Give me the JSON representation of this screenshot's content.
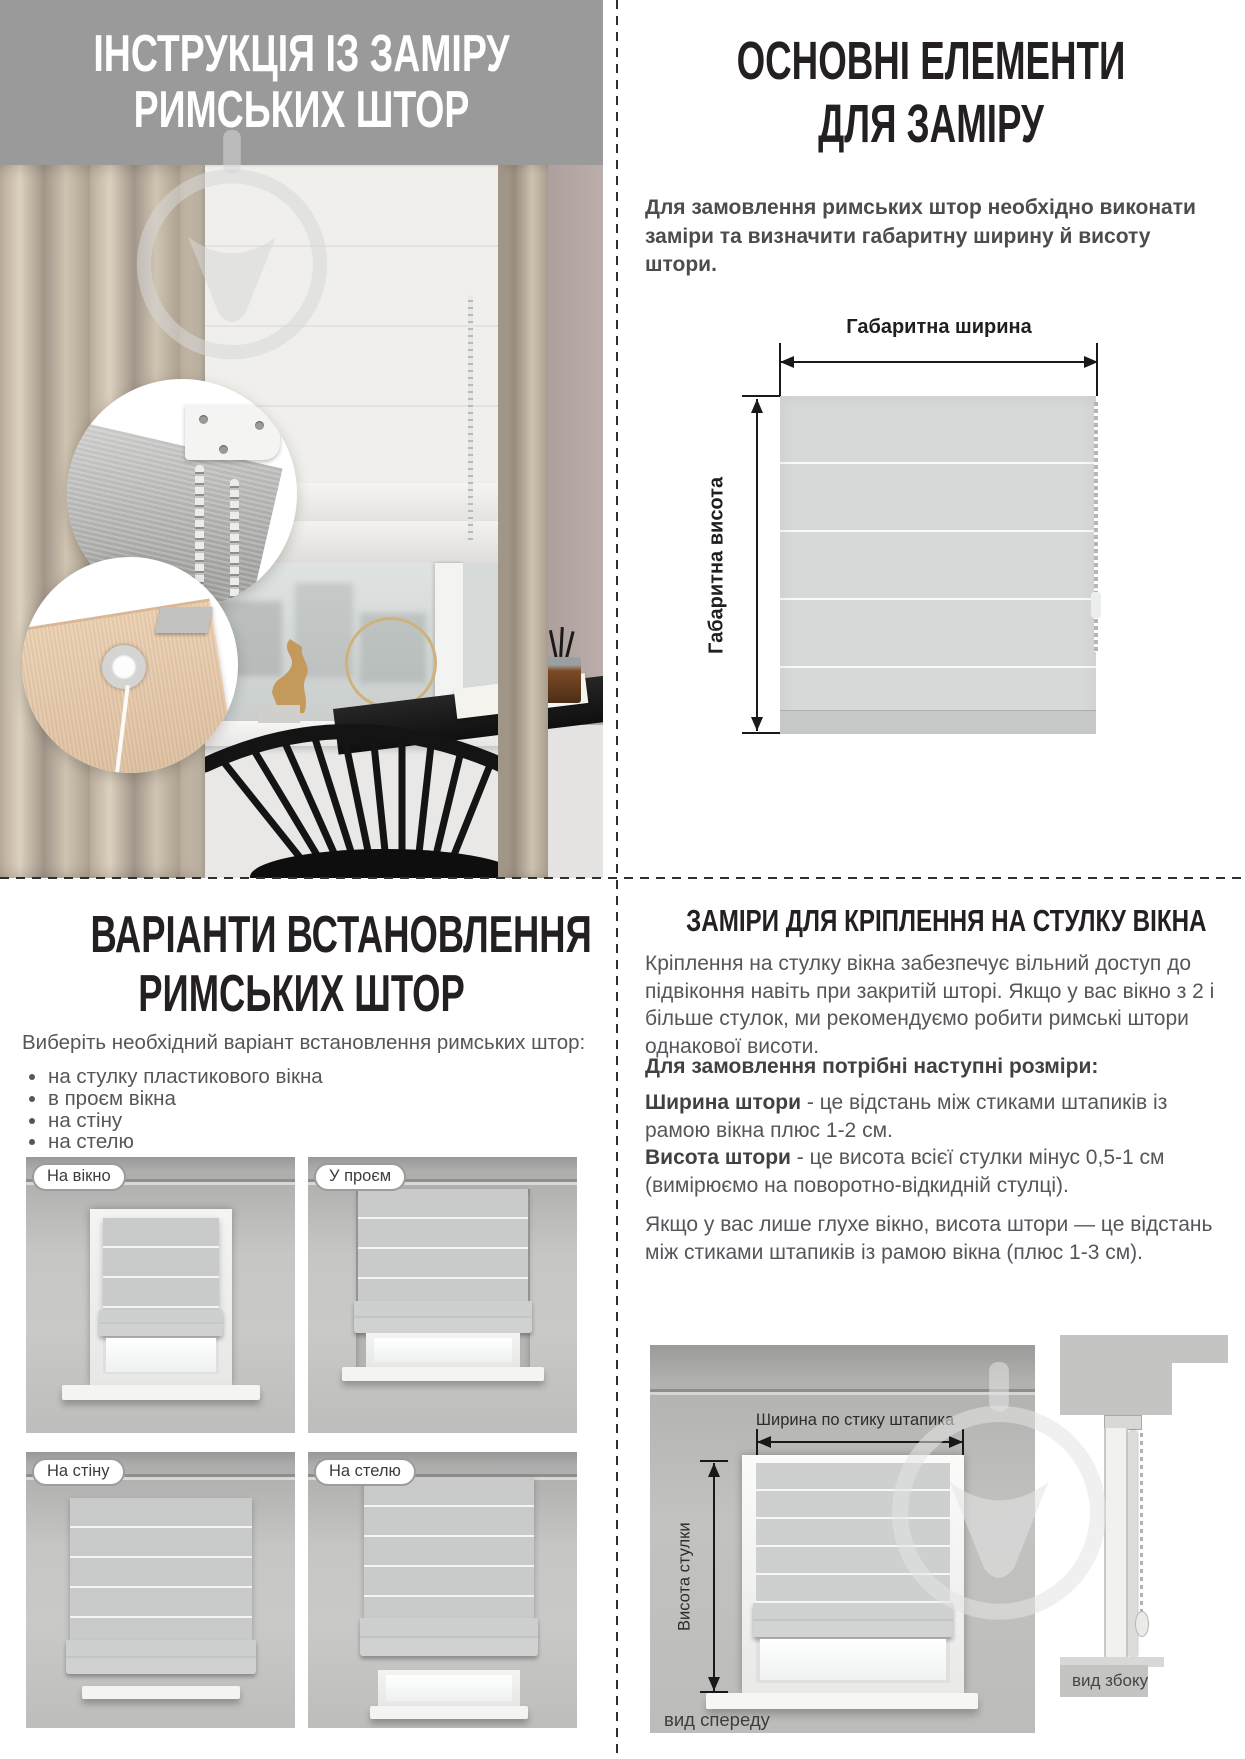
{
  "top_left": {
    "title_line1": "ІНСТРУКЦІЯ ІЗ ЗАМІРУ",
    "title_line2": "РИМСЬКИХ ШТОР"
  },
  "top_right": {
    "heading_line1": "ОСНОВНІ ЕЛЕМЕНТИ",
    "heading_line2": "ДЛЯ ЗАМІРУ",
    "intro": "Для замовлення римських штор необхідно виконати заміри та визначити габаритну ширину й висоту штори.",
    "diagram": {
      "width_label": "Габаритна ширина",
      "height_label": "Габаритна висота"
    }
  },
  "bottom_left": {
    "heading_line1": "ВАРІАНТИ ВСТАНОВЛЕННЯ",
    "heading_line2": "РИМСЬКИХ ШТОР",
    "intro": "Виберіть необхідний варіант встановлення римських штор:",
    "options": [
      "на стулку пластикового вікна",
      "в проєм вікна",
      "на стіну",
      "на стелю"
    ],
    "variants": [
      {
        "label": "На вікно"
      },
      {
        "label": "У проєм"
      },
      {
        "label": "На стіну"
      },
      {
        "label": "На стелю"
      }
    ]
  },
  "bottom_right": {
    "heading": "ЗАМІРИ ДЛЯ КРІПЛЕННЯ НА СТУЛКУ ВІКНА",
    "paragraph_mount": "Кріплення на стулку вікна забезпечує вільний доступ до підвіконня навіть при закритій шторі. Якщо у вас вікно з 2 і більше стулок, ми рекомендуємо робити римські штори однакової висоти.",
    "paragraph_sizes_title": "Для замовлення потрібні наступні розміри:",
    "size_width_term": "Ширина штори",
    "size_width_def": " - це відстань між стиками штапиків із рамою вікна плюс 1-2 см.",
    "size_height_term": "Висота штори",
    "size_height_def": " - це висота всієї стулки мінус 0,5-1 см (вимірюємо на поворотно-відкидній стулці).",
    "paragraph_blind_window": "Якщо у вас лише глухе вікно, висота штори — це відстань між стиками штапиків із рамою вікна (плюс 1-3 см).",
    "front_view": {
      "width_label": "Ширина по стику штапика",
      "height_label": "Висота стулки",
      "caption": "вид спереду"
    },
    "side_view": {
      "caption": "вид збоку"
    }
  },
  "colors": {
    "banner_bg": "#9a9a9a",
    "heading_text": "#242021",
    "body_text": "#55565a",
    "divider": "#2f2f2f",
    "blind_fill": "#d7d9d8"
  }
}
